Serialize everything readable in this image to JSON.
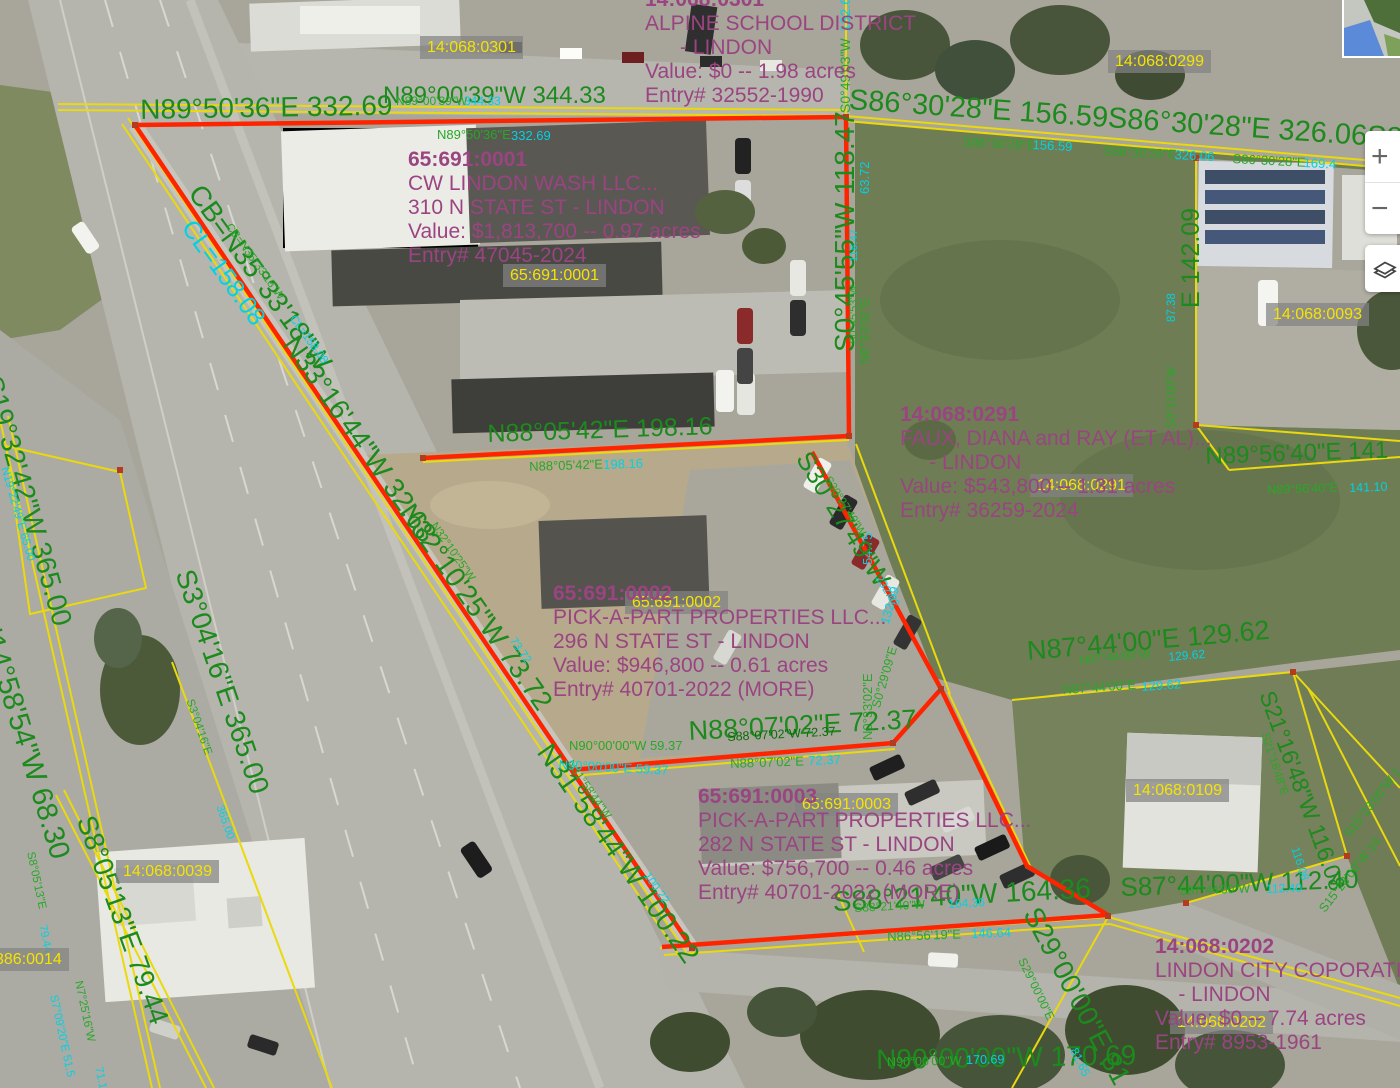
{
  "map": {
    "colors": {
      "g": "#1c8a1c",
      "gs": "#27a827",
      "gd": "#0a6b0a",
      "c": "#00d2e2",
      "purple": "#9a4482",
      "parcel_yellow": "#f5e400",
      "line_yellow": "#ead90c",
      "line_red": "#ff2400"
    },
    "parcel_id_labels": [
      {
        "text": "14:068:0301",
        "x": 420,
        "y": 36
      },
      {
        "text": "14:068:0299",
        "x": 1108,
        "y": 50
      },
      {
        "text": "65:691:0001",
        "x": 503,
        "y": 264
      },
      {
        "text": "14:068:0093",
        "x": 1266,
        "y": 303
      },
      {
        "text": "14:068:0291",
        "x": 1030,
        "y": 474
      },
      {
        "text": "65:691:0002",
        "x": 625,
        "y": 591
      },
      {
        "text": "65:691:0003",
        "x": 795,
        "y": 793
      },
      {
        "text": "14:068:0109",
        "x": 1126,
        "y": 779
      },
      {
        "text": "14:068:0039",
        "x": 116,
        "y": 860
      },
      {
        "text": "386:0014",
        "x": -12,
        "y": 948
      },
      {
        "text": "14:068:0202",
        "x": 1170,
        "y": 1011
      }
    ],
    "info_blocks": [
      {
        "x": 645,
        "y": -12,
        "lines": [
          "14:068:0301",
          "ALPINE SCHOOL DISTRICT",
          "      - LINDON",
          "Value: $0 -- 1.98 acres",
          "Entry# 32552-1990"
        ]
      },
      {
        "x": 408,
        "y": 148,
        "lines": [
          "65:691:0001",
          "CW LINDON WASH LLC...",
          "310 N STATE ST - LINDON",
          "Value: $1,813,700 -- 0.97 acres",
          "Entry# 47045-2024"
        ]
      },
      {
        "x": 900,
        "y": 403,
        "lines": [
          "14:068:0291",
          "FAUX, DIANA and RAY (ET AL)...",
          "     - LINDON",
          "Value: $543,800 -- 1.31 acres",
          "Entry# 36259-2024"
        ]
      },
      {
        "x": 553,
        "y": 582,
        "lines": [
          "65:691:0002",
          "PICK-A-PART PROPERTIES LLC...",
          "296 N STATE ST - LINDON",
          "Value: $946,800 -- 0.61 acres",
          "Entry# 40701-2022 (MORE)"
        ]
      },
      {
        "x": 698,
        "y": 785,
        "lines": [
          "65:691:0003",
          "PICK-A-PART PROPERTIES LLC...",
          "282 N STATE ST - LINDON",
          "Value: $756,700 -- 0.46 acres",
          "Entry# 40701-2022 (MORE)"
        ]
      },
      {
        "x": 1155,
        "y": 935,
        "lines": [
          "14:068:0202",
          "LINDON CITY COPORATION...",
          "    - LINDON",
          "Value: $0 -- 7.74 acres",
          "Entry# 8953-1961"
        ]
      }
    ],
    "dimension_labels": [
      {
        "text": "N89°50'36\"E 332.69",
        "x": 140,
        "y": 96,
        "r": -1,
        "s": 28,
        "c": "g"
      },
      {
        "text": "N89°00'39\"W 344.33",
        "x": 383,
        "y": 84,
        "r": 0,
        "s": 24,
        "c": "g"
      },
      {
        "text": "N89°00'39\"W",
        "x": 396,
        "y": 95,
        "r": 0,
        "s": 12,
        "c": "gs"
      },
      {
        "text": "344.33",
        "x": 464,
        "y": 95,
        "r": 0,
        "s": 12,
        "c": "c"
      },
      {
        "text": "N89°50'36\"E",
        "x": 437,
        "y": 128,
        "r": 0,
        "s": 13,
        "c": "gs"
      },
      {
        "text": "332.69",
        "x": 511,
        "y": 129,
        "r": 0,
        "s": 13,
        "c": "c"
      },
      {
        "text": "S86°30'28\"E 156.59S86°30'28\"E 326.06S86°30'28\"E 169.4",
        "x": 850,
        "y": 86,
        "r": 4,
        "s": 29,
        "c": "g"
      },
      {
        "text": "S86°30'28\"E",
        "x": 963,
        "y": 135,
        "r": 3,
        "s": 13,
        "c": "gs"
      },
      {
        "text": "156.59",
        "x": 1033,
        "y": 138,
        "r": 3,
        "s": 13,
        "c": "c"
      },
      {
        "text": "S86°30'28\"E",
        "x": 1104,
        "y": 144,
        "r": 3,
        "s": 13,
        "c": "gs"
      },
      {
        "text": "326.06",
        "x": 1175,
        "y": 148,
        "r": 3,
        "s": 13,
        "c": "c"
      },
      {
        "text": "S86°30'28\"E",
        "x": 1233,
        "y": 152,
        "r": 3,
        "s": 13,
        "c": "gs"
      },
      {
        "text": "169.4",
        "x": 1304,
        "y": 156,
        "r": 3,
        "s": 13,
        "c": "c"
      },
      {
        "text": "S0°49'03\"W",
        "x": 838,
        "y": 113,
        "r": -90,
        "s": 14,
        "c": "gs"
      },
      {
        "text": "132.6",
        "x": 838,
        "y": 32,
        "r": -90,
        "s": 14,
        "c": "c"
      },
      {
        "text": "S0°45'55\"W 118.47",
        "x": 831,
        "y": 352,
        "r": -90,
        "s": 28,
        "c": "g"
      },
      {
        "text": "S0°45'53\"W",
        "x": 849,
        "y": 344,
        "r": -90,
        "s": 11,
        "c": "gs"
      },
      {
        "text": "118.47",
        "x": 849,
        "y": 262,
        "r": -90,
        "s": 11,
        "c": "c"
      },
      {
        "text": "N0°33'02\"E",
        "x": 858,
        "y": 364,
        "r": -90,
        "s": 13,
        "c": "gs"
      },
      {
        "text": "63.72",
        "x": 858,
        "y": 194,
        "r": -90,
        "s": 13,
        "c": "c"
      },
      {
        "text": "N0°33'02\"E",
        "x": 861,
        "y": 740,
        "r": -90,
        "s": 13,
        "c": "gs"
      },
      {
        "text": "54.75",
        "x": 861,
        "y": 565,
        "r": -90,
        "s": 13,
        "c": "c"
      },
      {
        "text": "CB=N35°33'18\"W",
        "x": 206,
        "y": 180,
        "r": 54,
        "s": 28,
        "c": "g"
      },
      {
        "text": "CL=158.08",
        "x": 197,
        "y": 216,
        "r": 54,
        "s": 25,
        "c": "c"
      },
      {
        "text": "CB=N35°33'18\"W",
        "x": 232,
        "y": 222,
        "r": 54,
        "s": 11.5,
        "c": "gs"
      },
      {
        "text": "CL=158.08",
        "x": 296,
        "y": 314,
        "r": 54,
        "s": 11.5,
        "c": "c"
      },
      {
        "text": "N33°16'44\"W 32.68",
        "x": 301,
        "y": 331,
        "r": 55,
        "s": 28,
        "c": "g"
      },
      {
        "text": "N32°10'25\"W 73.72",
        "x": 417,
        "y": 499,
        "r": 55,
        "s": 28,
        "c": "g"
      },
      {
        "text": "N32°10'25\"W",
        "x": 437,
        "y": 521,
        "r": 55,
        "s": 11.5,
        "c": "gs"
      },
      {
        "text": "73.72",
        "x": 516,
        "y": 636,
        "r": 55,
        "s": 11.5,
        "c": "c"
      },
      {
        "text": "N31°58'44\"W 100.22",
        "x": 555,
        "y": 739,
        "r": 55,
        "s": 28,
        "c": "g"
      },
      {
        "text": "N31°58'44\"W",
        "x": 573,
        "y": 759,
        "r": 55,
        "s": 11.5,
        "c": "gs"
      },
      {
        "text": "100.22",
        "x": 650,
        "y": 871,
        "r": 55,
        "s": 11.5,
        "c": "c"
      },
      {
        "text": "N88°05'42\"E 198.16",
        "x": 487,
        "y": 422,
        "r": -2,
        "s": 25,
        "c": "g"
      },
      {
        "text": "N88°05'42\"E",
        "x": 529,
        "y": 460,
        "r": -2,
        "s": 13,
        "c": "gs"
      },
      {
        "text": "198.16",
        "x": 603,
        "y": 458,
        "r": -2,
        "s": 13,
        "c": "c"
      },
      {
        "text": "S30°27'49\"W",
        "x": 814,
        "y": 447,
        "r": 58,
        "s": 26,
        "c": "g"
      },
      {
        "text": "S30°27'49\"W",
        "x": 831,
        "y": 475,
        "r": 58,
        "s": 11.5,
        "c": "gs"
      },
      {
        "text": "232.62",
        "x": 882,
        "y": 574,
        "r": 58,
        "s": 11.5,
        "c": "c"
      },
      {
        "text": "S0°29'09\"E",
        "x": 870,
        "y": 706,
        "r": -74,
        "s": 12.5,
        "c": "gs"
      },
      {
        "text": "132.09",
        "x": 879,
        "y": 622,
        "r": -74,
        "s": 12.5,
        "c": "c"
      },
      {
        "text": "N90°00'00\"W 59.37",
        "x": 569,
        "y": 739,
        "r": 0,
        "s": 13,
        "c": "gs"
      },
      {
        "text": "N90°00'00\"E 59.37",
        "x": 559,
        "y": 758,
        "r": 3,
        "s": 13,
        "c": "c"
      },
      {
        "text": "N88°07'02\"E 72.37",
        "x": 688,
        "y": 718,
        "r": -3,
        "s": 27,
        "c": "g"
      },
      {
        "text": "S88°07'02\"W 72.37",
        "x": 727,
        "y": 731,
        "r": -3,
        "s": 12.5,
        "c": "gd"
      },
      {
        "text": "N88°07'02\"E",
        "x": 730,
        "y": 757,
        "r": -2,
        "s": 13,
        "c": "gs"
      },
      {
        "text": "72.37",
        "x": 808,
        "y": 754,
        "r": -2,
        "s": 13,
        "c": "c"
      },
      {
        "text": "S88°21'40\"W 164.36",
        "x": 832,
        "y": 888,
        "r": -3,
        "s": 28,
        "c": "g"
      },
      {
        "text": "S88°21'40\"W",
        "x": 854,
        "y": 902,
        "r": -3,
        "s": 12,
        "c": "gs"
      },
      {
        "text": "164.36",
        "x": 948,
        "y": 898,
        "r": -3,
        "s": 12,
        "c": "c"
      },
      {
        "text": "N86°56'19\"E",
        "x": 887,
        "y": 930,
        "r": -2,
        "s": 13,
        "c": "gs"
      },
      {
        "text": "146.64",
        "x": 971,
        "y": 927,
        "r": -2,
        "s": 13,
        "c": "c"
      },
      {
        "text": "N90°00'00\"W 170.69",
        "x": 876,
        "y": 1046,
        "r": -1,
        "s": 28,
        "c": "g"
      },
      {
        "text": "N90°00'00\"W",
        "x": 887,
        "y": 1056,
        "r": -1,
        "s": 12.5,
        "c": "gs"
      },
      {
        "text": "170.69",
        "x": 966,
        "y": 1054,
        "r": -1,
        "s": 12.5,
        "c": "c"
      },
      {
        "text": "S29°00'00\"E 81.65",
        "x": 1043,
        "y": 903,
        "r": 62,
        "s": 28,
        "c": "g"
      },
      {
        "text": "S29°00'00\"E",
        "x": 1027,
        "y": 956,
        "r": 64,
        "s": 12,
        "c": "gs"
      },
      {
        "text": "81.65",
        "x": 1079,
        "y": 1046,
        "r": 64,
        "s": 12,
        "c": "c"
      },
      {
        "text": "S87°44'00\"W 112.40",
        "x": 1120,
        "y": 874,
        "r": -2,
        "s": 26,
        "c": "g"
      },
      {
        "text": "S87°44'00\"W",
        "x": 1179,
        "y": 885,
        "r": -2,
        "s": 12,
        "c": "gs"
      },
      {
        "text": "112.40",
        "x": 1266,
        "y": 883,
        "r": -2,
        "s": 12,
        "c": "c"
      },
      {
        "text": "N87°44'00\"E 129.62",
        "x": 1026,
        "y": 638,
        "r": -5,
        "s": 27,
        "c": "g"
      },
      {
        "text": "N87°44'00\"W",
        "x": 1079,
        "y": 654,
        "r": -5,
        "s": 12,
        "c": "gs"
      },
      {
        "text": "129.62",
        "x": 1168,
        "y": 651,
        "r": -5,
        "s": 12,
        "c": "c"
      },
      {
        "text": "N87°44'00\"E",
        "x": 1062,
        "y": 683,
        "r": -4,
        "s": 13,
        "c": "gs"
      },
      {
        "text": "129.62",
        "x": 1141,
        "y": 680,
        "r": -4,
        "s": 13,
        "c": "c"
      },
      {
        "text": "N89°56'40\"E 141",
        "x": 1205,
        "y": 445,
        "r": -2,
        "s": 24,
        "c": "g"
      },
      {
        "text": "N89°56'40\"E",
        "x": 1267,
        "y": 484,
        "r": -2,
        "s": 12.5,
        "c": "gs"
      },
      {
        "text": "141.10",
        "x": 1349,
        "y": 482,
        "r": -2,
        "s": 12.5,
        "c": "c"
      },
      {
        "text": "E 142.09",
        "x": 1179,
        "y": 308,
        "r": -90,
        "s": 25,
        "c": "g"
      },
      {
        "text": "S0°31'00\"W",
        "x": 1167,
        "y": 428,
        "r": -90,
        "s": 11.5,
        "c": "gs"
      },
      {
        "text": "87.38",
        "x": 1167,
        "y": 322,
        "r": -90,
        "s": 11.5,
        "c": "c"
      },
      {
        "text": "S21°16'48\"W 116.08",
        "x": 1277,
        "y": 688,
        "r": 70,
        "s": 23,
        "c": "g"
      },
      {
        "text": "S21°16'48\"E",
        "x": 1269,
        "y": 732,
        "r": 72,
        "s": 11.5,
        "c": "gs"
      },
      {
        "text": "116.08",
        "x": 1299,
        "y": 846,
        "r": 72,
        "s": 11.5,
        "c": "c"
      },
      {
        "text": "S15°23'00\"W 1",
        "x": 1342,
        "y": 832,
        "r": -52,
        "s": 12.5,
        "c": "gs"
      },
      {
        "text": "S15°23'00\"W 14",
        "x": 1317,
        "y": 907,
        "r": -52,
        "s": 12.5,
        "c": "gs"
      },
      {
        "text": "S19°32'42\"W 365.00",
        "x": 5,
        "y": 373,
        "r": 74,
        "s": 28,
        "c": "g"
      },
      {
        "text": "N19°22'49\"E 65.00",
        "x": 9,
        "y": 466,
        "r": 74,
        "s": 11.5,
        "c": "c"
      },
      {
        "text": "N14°58'54\"W 68.30",
        "x": 0,
        "y": 612,
        "r": 73,
        "s": 29,
        "c": "g"
      },
      {
        "text": "S8°05'13\"E 79.44",
        "x": 98,
        "y": 812,
        "r": 70,
        "s": 28,
        "c": "g"
      },
      {
        "text": "S8°05'13\"E",
        "x": 35,
        "y": 851,
        "r": 78,
        "s": 11.5,
        "c": "gs"
      },
      {
        "text": "79.44",
        "x": 47,
        "y": 924,
        "r": 78,
        "s": 11.5,
        "c": "c"
      },
      {
        "text": "N7°25'16\"W",
        "x": 83,
        "y": 980,
        "r": 78,
        "s": 11.5,
        "c": "gs"
      },
      {
        "text": "71.16",
        "x": 103,
        "y": 1066,
        "r": 78,
        "s": 11.5,
        "c": "c"
      },
      {
        "text": "S7°09'20\"E 51.5",
        "x": 58,
        "y": 994,
        "r": 78,
        "s": 11.5,
        "c": "c"
      },
      {
        "text": "S3°04'16\"E 365.00",
        "x": 197,
        "y": 566,
        "r": 71,
        "s": 28,
        "c": "g"
      },
      {
        "text": "S3°04'16\"E",
        "x": 194,
        "y": 698,
        "r": 71,
        "s": 11.5,
        "c": "gs"
      },
      {
        "text": "365.00",
        "x": 224,
        "y": 804,
        "r": 71,
        "s": 11.5,
        "c": "c"
      }
    ]
  },
  "controls": {
    "zoom_in_label": "+",
    "zoom_out_label": "−"
  }
}
